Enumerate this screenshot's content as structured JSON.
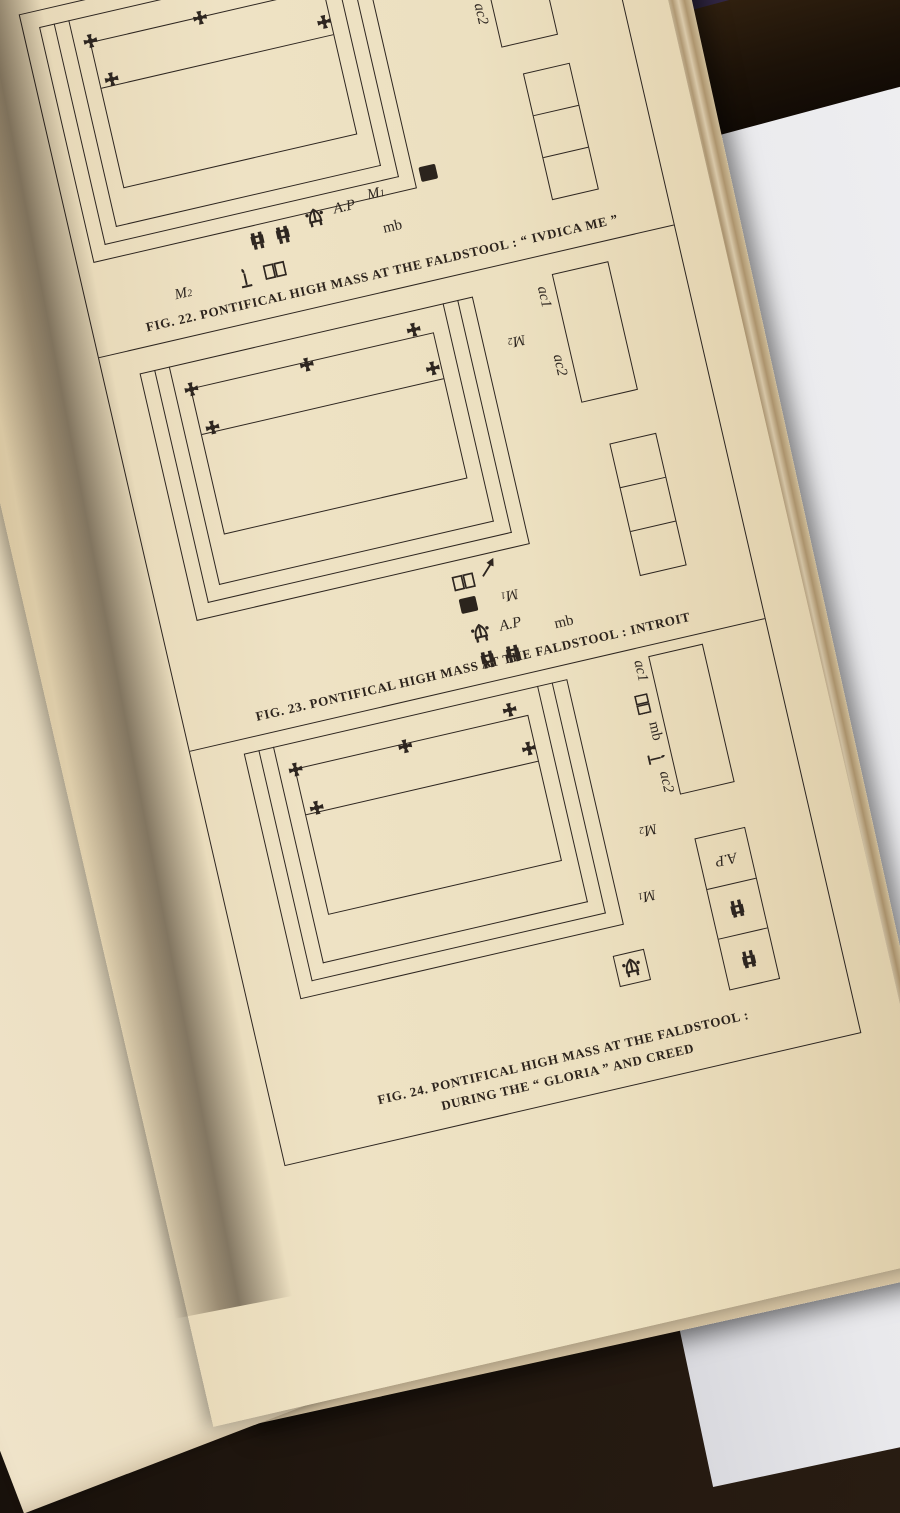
{
  "colors": {
    "page": "#ecdfc0",
    "ink": "#2e2620",
    "surface": "#e9e9ec",
    "red_book": "#6d2030"
  },
  "left_page": {
    "lines": [
      {
        "t": "s it on the"
      },
      {
        "t": "He bows"
      },
      {
        "t": "op’s right"
      },
      {
        "t": "r the M.C."
      },
      {
        "t": "uts on the",
        "gap": true
      },
      {
        "t": ". is at his"
      },
      {
        "t": "ow carries"
      },
      {
        "t": "left.  The"
      },
      {
        "t": "reverence"
      },
      {
        "t": "When the"
      },
      {
        "t": "piscopalis",
        "em": true
      },
      {
        "t": "er a nobis,",
        "em": true,
        "gap": true
      },
      {
        "t": "it to the"
      },
      {
        "t": "ct.  Mass"
      },
      {
        "t": "ministers"
      },
      {
        "t": "con puts"
      },
      {
        "t": "(p. 182)."
      },
      {
        "t": "A.P. and"
      },
      {
        "t": "the sub-"
      },
      {
        "t": "y ;  the"
      },
      {
        "t": "bishop,"
      },
      {
        "t": "ends in"
      },
      {
        "t": ". takes"
      },
      {
        "t": "-candle"
      },
      {
        "t": "usual,"
      },
      {
        "t": "issime.",
        "em": true
      },
      {
        "t": "uts on",
        "gap": true
      },
      {
        "t": "wn the"
      },
      {
        "t": "es per"
      },
      {
        "t": "The"
      },
      {
        "t": "mpany"
      },
      {
        "t": "es the"
      },
      {
        "t": "The"
      },
      {
        "t": "issal,"
      },
      {
        "t": "t the"
      },
      {
        "t": "t the"
      },
      {
        "t": ", but"
      },
      {
        "t": "Kyrie",
        "em": true
      },
      {
        "t": "time",
        "gap": true
      },
      {
        "t": "ia in",
        "em": true
      },
      {
        "t": "the"
      }
    ]
  },
  "right_page": {
    "figures": [
      {
        "caption": "FIG. 22. PONTIFICAL HIGH MASS AT THE FALDSTOOL : “ IVDICA ME ”",
        "labels": {
          "ac1": "ac1",
          "ac2": "ac2",
          "m1_base": "M",
          "m1_sub": "1",
          "m2_base": "M",
          "m2_sub": "2",
          "ap": "A.P",
          "mb": "mb"
        }
      },
      {
        "caption": "FIG. 23. PONTIFICAL HIGH MASS AT THE FALDSTOOL : INTROIT",
        "labels": {
          "ac1": "ac1",
          "ac2": "ac2",
          "m1_base": "M",
          "m1_sub": "1",
          "m2_base": "M",
          "m2_sub": "2",
          "ap": "A.P",
          "mb": "mb"
        }
      },
      {
        "caption_line1": "FIG. 24. PONTIFICAL HIGH MASS AT THE FALDSTOOL :",
        "caption_line2": "DURING THE “ GLORIA ” AND CREED",
        "labels": {
          "ac1": "ac1",
          "ac2": "ac2",
          "m1_base": "M",
          "m1_sub": "1",
          "m2_base": "M",
          "m2_sub": "2",
          "ap": "A.P",
          "mb": "mb"
        }
      }
    ]
  }
}
